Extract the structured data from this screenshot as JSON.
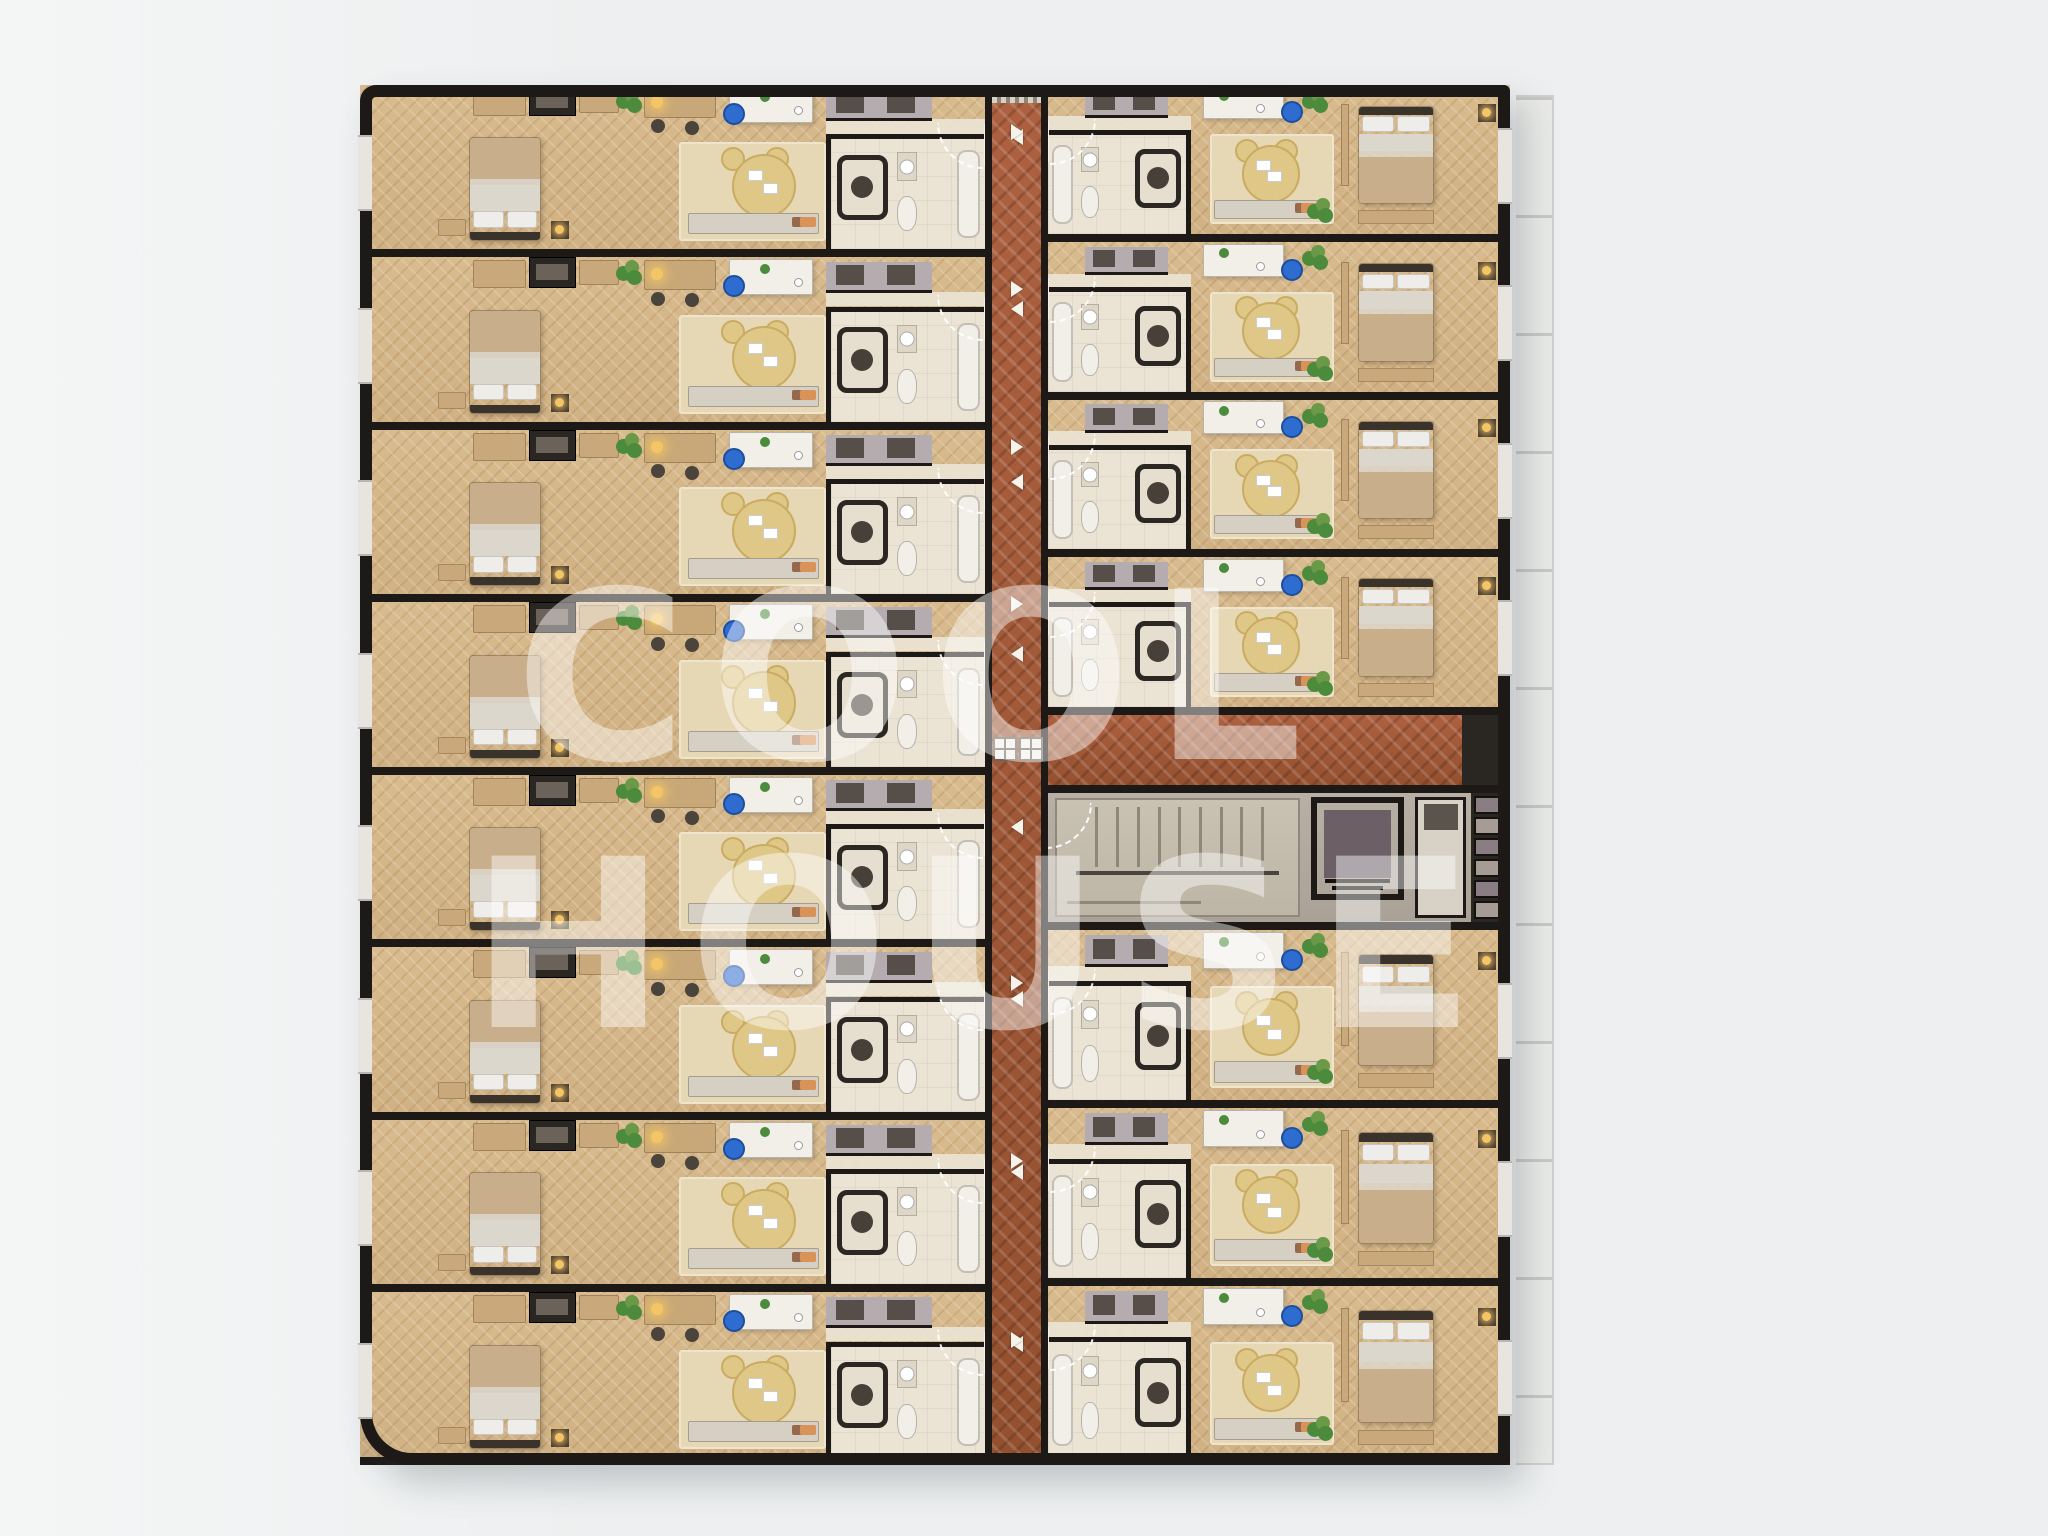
{
  "watermark": {
    "line1": "COOL",
    "line2": "HOUSE"
  },
  "palette": {
    "bg": "#edeff0",
    "bg-left": "#f4f6f6",
    "wall": "#1c1917",
    "brick1": "#ad6140",
    "brick2": "#93502f",
    "wood1": "#d8bb8e",
    "wood2": "#d0b183",
    "rug": "#e6d7b5",
    "tile": "#ebe4d5",
    "closet": "#b5acaf",
    "closet-panel": "#564f49",
    "core-floor": "#b8b0a4",
    "stair": "#c9c1b2",
    "stair-line": "#8f8779",
    "elev-car": "#6c5f66",
    "shelf-a": "#8a7e84",
    "shelf-b": "#a79b96",
    "duct": "#2a2622",
    "white-obj": "#f2efe9",
    "desk-wood": "#c8a878",
    "furn-wood": "#c9a97b",
    "blanket": "#c9ae8b",
    "sheet": "#dcd7cd",
    "pillow": "#efede9",
    "headbar": "#3a332c",
    "chair-yellow": "#dfc787",
    "chair-yellow2": "#c9ab62",
    "chair-blue": "#2f6cd0",
    "console": "#d6cfc4",
    "cushion-brown": "#96684c",
    "cushion-orange": "#d99257",
    "plant1": "#4c8a3c",
    "plant2": "#6a9a47",
    "lamp": "#f3c566",
    "shower-head": "#474038",
    "arc": "rgba(255,255,255,0.92)",
    "arrow": "#f6f3ec",
    "terrace": "#e9eae8",
    "terrace-line": "#c7c8c6",
    "window": "#e8e5e0",
    "watermark": "rgba(255,255,255,0.45)"
  },
  "layout": {
    "canvas": {
      "w": 2048,
      "h": 1536
    },
    "building": {
      "x": 360,
      "y": 85,
      "w": 1150,
      "h": 1380
    },
    "left_col": {
      "x": 360,
      "w": 625
    },
    "corridor": {
      "x": 985,
      "w": 63,
      "top": 85,
      "bottom": 1465
    },
    "right_col": {
      "x": 1048,
      "w": 462
    },
    "branch": {
      "y": 715,
      "h": 70
    },
    "core": {
      "y": 785,
      "h": 145
    },
    "terrace": {
      "x": 1516,
      "y": 95,
      "w": 36,
      "h": 1366
    }
  },
  "units": [
    {
      "id": "L1",
      "side": "left",
      "top": 85,
      "height": 172
    },
    {
      "id": "L2",
      "side": "left",
      "top": 257,
      "height": 173
    },
    {
      "id": "L3",
      "side": "left",
      "top": 430,
      "height": 172
    },
    {
      "id": "L4",
      "side": "left",
      "top": 602,
      "height": 173
    },
    {
      "id": "L5",
      "side": "left",
      "top": 775,
      "height": 172
    },
    {
      "id": "L6",
      "side": "left",
      "top": 947,
      "height": 173
    },
    {
      "id": "L7",
      "side": "left",
      "top": 1120,
      "height": 172
    },
    {
      "id": "L8",
      "side": "left",
      "top": 1292,
      "height": 173
    },
    {
      "id": "R1",
      "side": "right",
      "top": 85,
      "height": 157
    },
    {
      "id": "R2",
      "side": "right",
      "top": 242,
      "height": 158
    },
    {
      "id": "R3",
      "side": "right",
      "top": 400,
      "height": 157
    },
    {
      "id": "R4",
      "side": "right",
      "top": 557,
      "height": 158
    },
    {
      "id": "R5",
      "side": "right",
      "top": 930,
      "height": 178
    },
    {
      "id": "R6",
      "side": "right",
      "top": 1108,
      "height": 178
    },
    {
      "id": "R7",
      "side": "right",
      "top": 1286,
      "height": 179
    }
  ],
  "unit_features": [
    "double-bed",
    "pillows",
    "wardrobe",
    "tv-niche",
    "cabinet",
    "console-table",
    "desk-lamp",
    "desk",
    "desk-chair",
    "lounge-armchair",
    "media-console",
    "rug",
    "plant",
    "bench",
    "nightstand",
    "bathroom",
    "shower",
    "toilet",
    "sink",
    "bathtub",
    "entry-door-swing"
  ],
  "core": {
    "stair_treads": 9,
    "shelf_cells": 6,
    "elements": [
      "staircase",
      "elevator",
      "utility-room",
      "storage-shelves",
      "door-swing"
    ]
  },
  "corridor_info": {
    "floor": "terracotta-herringbone",
    "door_arrows": 15,
    "entry_mat": true,
    "floor_drains": 2
  }
}
